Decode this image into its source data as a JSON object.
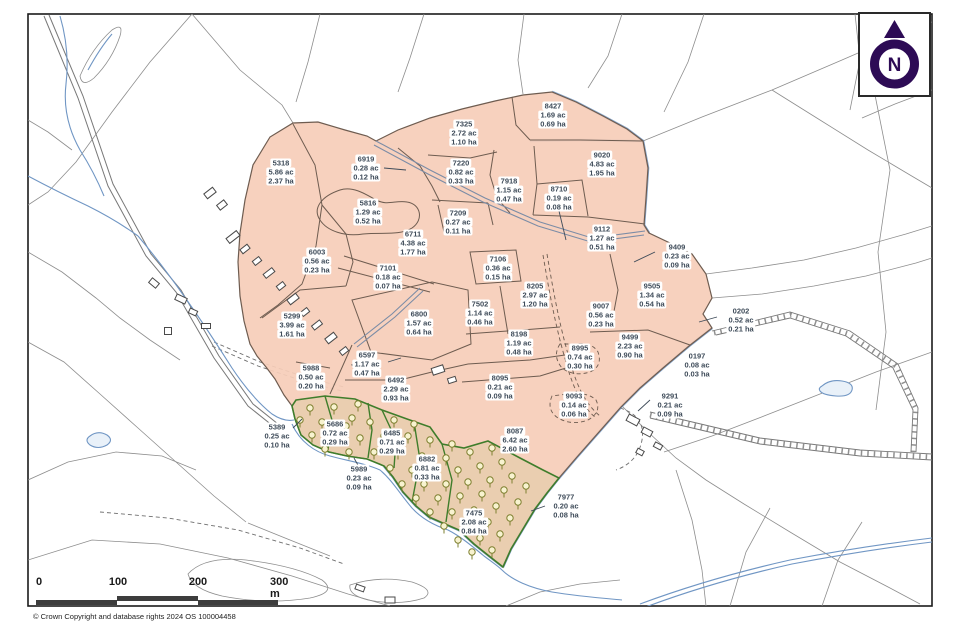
{
  "page": {
    "width": 958,
    "height": 637
  },
  "map": {
    "colors": {
      "holding_fill": "#f6cdb8",
      "parcel_boundary": "#6e5c50",
      "woodland_green": "#3f7d2b",
      "tree_olive": "#7e8030",
      "water_blue": "#7096c4",
      "background_line": "#8d8d8d",
      "label_text": "#3e4b59",
      "north_symbol": "#2d0b55",
      "scalebar_dark": "#3d3d3d"
    },
    "woodland_parcel_ids": [
      "5686",
      "6485",
      "6882",
      "7475"
    ],
    "parcels": [
      {
        "id": "5318",
        "acres": "5.86 ac",
        "hectares": "2.37 ha",
        "x": 281,
        "y": 172
      },
      {
        "id": "6919",
        "acres": "0.28 ac",
        "hectares": "0.12 ha",
        "x": 366,
        "y": 168,
        "leader": [
          [
            384,
            168
          ],
          [
            406,
            170
          ]
        ]
      },
      {
        "id": "7325",
        "acres": "2.72 ac",
        "hectares": "1.10 ha",
        "x": 464,
        "y": 133
      },
      {
        "id": "8427",
        "acres": "1.69 ac",
        "hectares": "0.69 ha",
        "x": 553,
        "y": 115
      },
      {
        "id": "9020",
        "acres": "4.83 ac",
        "hectares": "1.95 ha",
        "x": 602,
        "y": 164
      },
      {
        "id": "7220",
        "acres": "0.82 ac",
        "hectares": "0.33 ha",
        "x": 461,
        "y": 172
      },
      {
        "id": "7918",
        "acres": "1.15 ac",
        "hectares": "0.47 ha",
        "x": 509,
        "y": 190
      },
      {
        "id": "8710",
        "acres": "0.19 ac",
        "hectares": "0.08 ha",
        "x": 559,
        "y": 198,
        "leader": [
          [
            559,
            211
          ],
          [
            566,
            240
          ]
        ]
      },
      {
        "id": "5816",
        "acres": "1.29 ac",
        "hectares": "0.52 ha",
        "x": 368,
        "y": 212
      },
      {
        "id": "7209",
        "acres": "0.27 ac",
        "hectares": "0.11 ha",
        "x": 458,
        "y": 222
      },
      {
        "id": "9112",
        "acres": "1.27 ac",
        "hectares": "0.51 ha",
        "x": 602,
        "y": 238
      },
      {
        "id": "6711",
        "acres": "4.38 ac",
        "hectares": "1.77 ha",
        "x": 413,
        "y": 243
      },
      {
        "id": "9409",
        "acres": "0.23 ac",
        "hectares": "0.09 ha",
        "x": 677,
        "y": 256,
        "leader": [
          [
            655,
            252
          ],
          [
            634,
            262
          ]
        ]
      },
      {
        "id": "6003",
        "acres": "0.56 ac",
        "hectares": "0.23 ha",
        "x": 317,
        "y": 261
      },
      {
        "id": "7106",
        "acres": "0.36 ac",
        "hectares": "0.15 ha",
        "x": 498,
        "y": 268
      },
      {
        "id": "7101",
        "acres": "0.18 ac",
        "hectares": "0.07 ha",
        "x": 388,
        "y": 277
      },
      {
        "id": "8205",
        "acres": "2.97 ac",
        "hectares": "1.20 ha",
        "x": 535,
        "y": 295
      },
      {
        "id": "9505",
        "acres": "1.34 ac",
        "hectares": "0.54 ha",
        "x": 652,
        "y": 295
      },
      {
        "id": "7502",
        "acres": "1.14 ac",
        "hectares": "0.46 ha",
        "x": 480,
        "y": 313
      },
      {
        "id": "9007",
        "acres": "0.56 ac",
        "hectares": "0.23 ha",
        "x": 601,
        "y": 315
      },
      {
        "id": "0202",
        "acres": "0.52 ac",
        "hectares": "0.21 ha",
        "x": 741,
        "y": 320,
        "leader": [
          [
            717,
            317
          ],
          [
            699,
            322
          ]
        ]
      },
      {
        "id": "5299",
        "acres": "3.99 ac",
        "hectares": "1.61 ha",
        "x": 292,
        "y": 325
      },
      {
        "id": "6800",
        "acres": "1.57 ac",
        "hectares": "0.64 ha",
        "x": 419,
        "y": 323
      },
      {
        "id": "8198",
        "acres": "1.19 ac",
        "hectares": "0.48 ha",
        "x": 519,
        "y": 343
      },
      {
        "id": "9499",
        "acres": "2.23 ac",
        "hectares": "0.90 ha",
        "x": 630,
        "y": 346
      },
      {
        "id": "8995",
        "acres": "0.74 ac",
        "hectares": "0.30 ha",
        "x": 580,
        "y": 357
      },
      {
        "id": "6597",
        "acres": "1.17 ac",
        "hectares": "0.47 ha",
        "x": 367,
        "y": 364,
        "leader": [
          [
            388,
            362
          ],
          [
            401,
            358
          ]
        ]
      },
      {
        "id": "0197",
        "acres": "0.08 ac",
        "hectares": "0.03 ha",
        "x": 697,
        "y": 365
      },
      {
        "id": "5988",
        "acres": "0.50 ac",
        "hectares": "0.20 ha",
        "x": 311,
        "y": 377
      },
      {
        "id": "6492",
        "acres": "2.29 ac",
        "hectares": "0.93 ha",
        "x": 396,
        "y": 389
      },
      {
        "id": "8095",
        "acres": "0.21 ac",
        "hectares": "0.09 ha",
        "x": 500,
        "y": 387
      },
      {
        "id": "9093",
        "acres": "0.14 ac",
        "hectares": "0.06 ha",
        "x": 574,
        "y": 405
      },
      {
        "id": "9291",
        "acres": "0.21 ac",
        "hectares": "0.09 ha",
        "x": 670,
        "y": 405,
        "leader": [
          [
            650,
            400
          ],
          [
            638,
            411
          ]
        ]
      },
      {
        "id": "5389",
        "acres": "0.25 ac",
        "hectares": "0.10 ha",
        "x": 277,
        "y": 436,
        "leader": [
          [
            293,
            428
          ],
          [
            302,
            419
          ]
        ]
      },
      {
        "id": "5686",
        "acres": "0.72 ac",
        "hectares": "0.29 ha",
        "x": 335,
        "y": 433
      },
      {
        "id": "6485",
        "acres": "0.71 ac",
        "hectares": "0.29 ha",
        "x": 392,
        "y": 442
      },
      {
        "id": "8087",
        "acres": "6.42 ac",
        "hectares": "2.60 ha",
        "x": 515,
        "y": 440
      },
      {
        "id": "6882",
        "acres": "0.81 ac",
        "hectares": "0.33 ha",
        "x": 427,
        "y": 468
      },
      {
        "id": "5989",
        "acres": "0.23 ac",
        "hectares": "0.09 ha",
        "x": 359,
        "y": 478,
        "leader": [
          [
            359,
            467
          ],
          [
            354,
            458
          ]
        ]
      },
      {
        "id": "7475",
        "acres": "2.08 ac",
        "hectares": "0.84 ha",
        "x": 474,
        "y": 522
      },
      {
        "id": "7977",
        "acres": "0.20 ac",
        "hectares": "0.08 ha",
        "x": 566,
        "y": 506,
        "leader": [
          [
            545,
            506
          ],
          [
            531,
            511
          ]
        ]
      }
    ]
  },
  "north_arrow": {
    "label": "N"
  },
  "scale_bar": {
    "ticks": [
      "0",
      "100",
      "200",
      "300 m"
    ]
  },
  "footer": {
    "copyright": "© Crown Copyright and database rights 2024 OS 100004458"
  }
}
